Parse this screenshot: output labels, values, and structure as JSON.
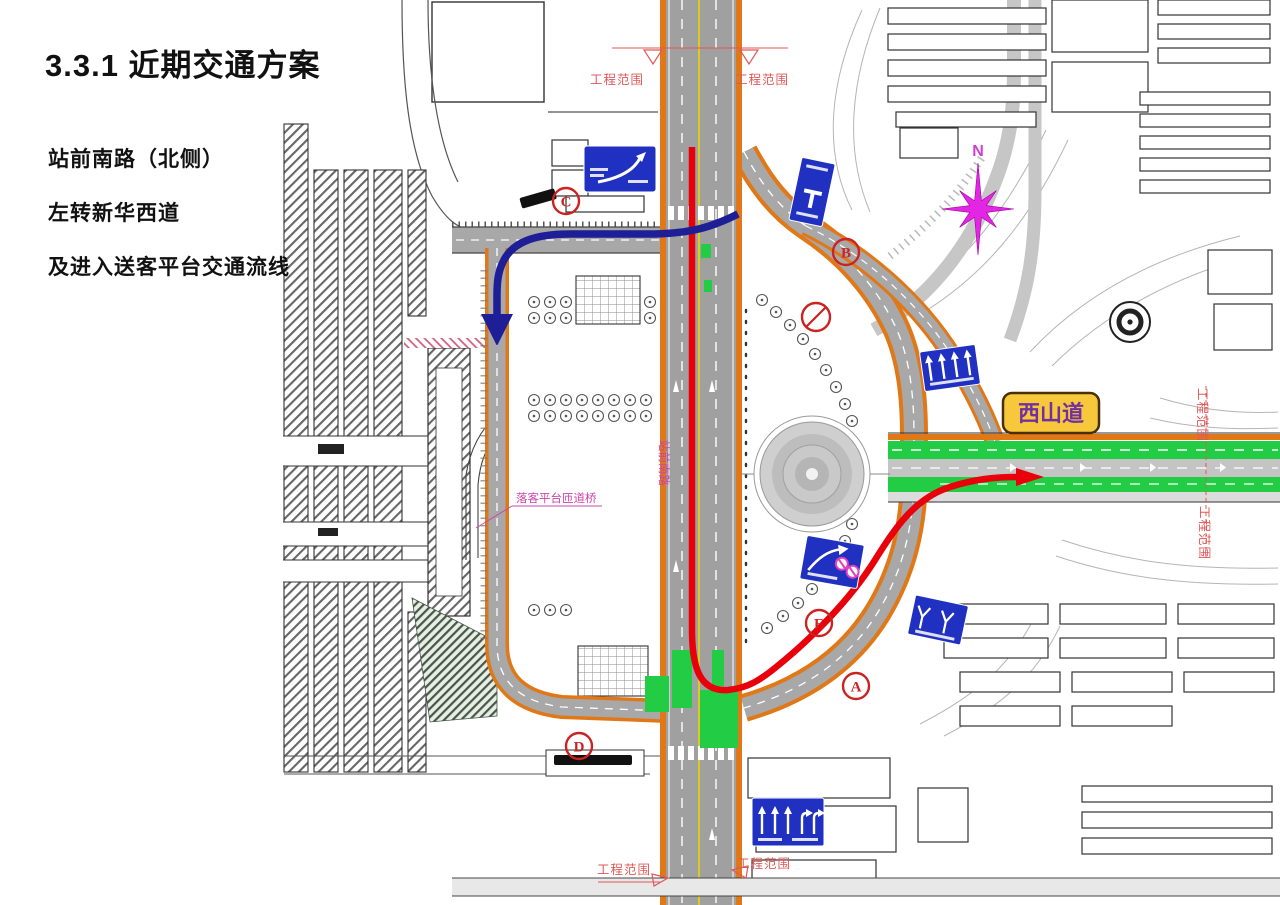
{
  "page": {
    "title": "3.3.1 近期交通方案",
    "description_lines": [
      "站前南路（北侧）",
      "左转新华西道",
      "及进入送客平台交通流线"
    ]
  },
  "map": {
    "compass_label": "N",
    "labels": {
      "xishan_road": "西山道",
      "zhanqian_south_road": "站前南路",
      "dropoff_ramp_bridge": "落客平台匝道桥",
      "project_scope": "工程范围"
    },
    "markers": [
      {
        "id": "A"
      },
      {
        "id": "B"
      },
      {
        "id": "C"
      },
      {
        "id": "D"
      },
      {
        "id": "E"
      }
    ],
    "colors": {
      "flow_red": "#e8000a",
      "flow_blue": "#1e1e96",
      "road_edge_orange": "#e07818",
      "road_gray": "#a8a8a8",
      "green_lane": "#22cc44",
      "sign_blue": "#2030c0",
      "label_yellow_bg": "#f8c83c",
      "label_purple_text": "#7030a0",
      "compass_magenta": "#e326e3",
      "scope_red": "#e05858",
      "pink_annotation": "#cc44aa",
      "marker_red": "#cc2222"
    }
  }
}
